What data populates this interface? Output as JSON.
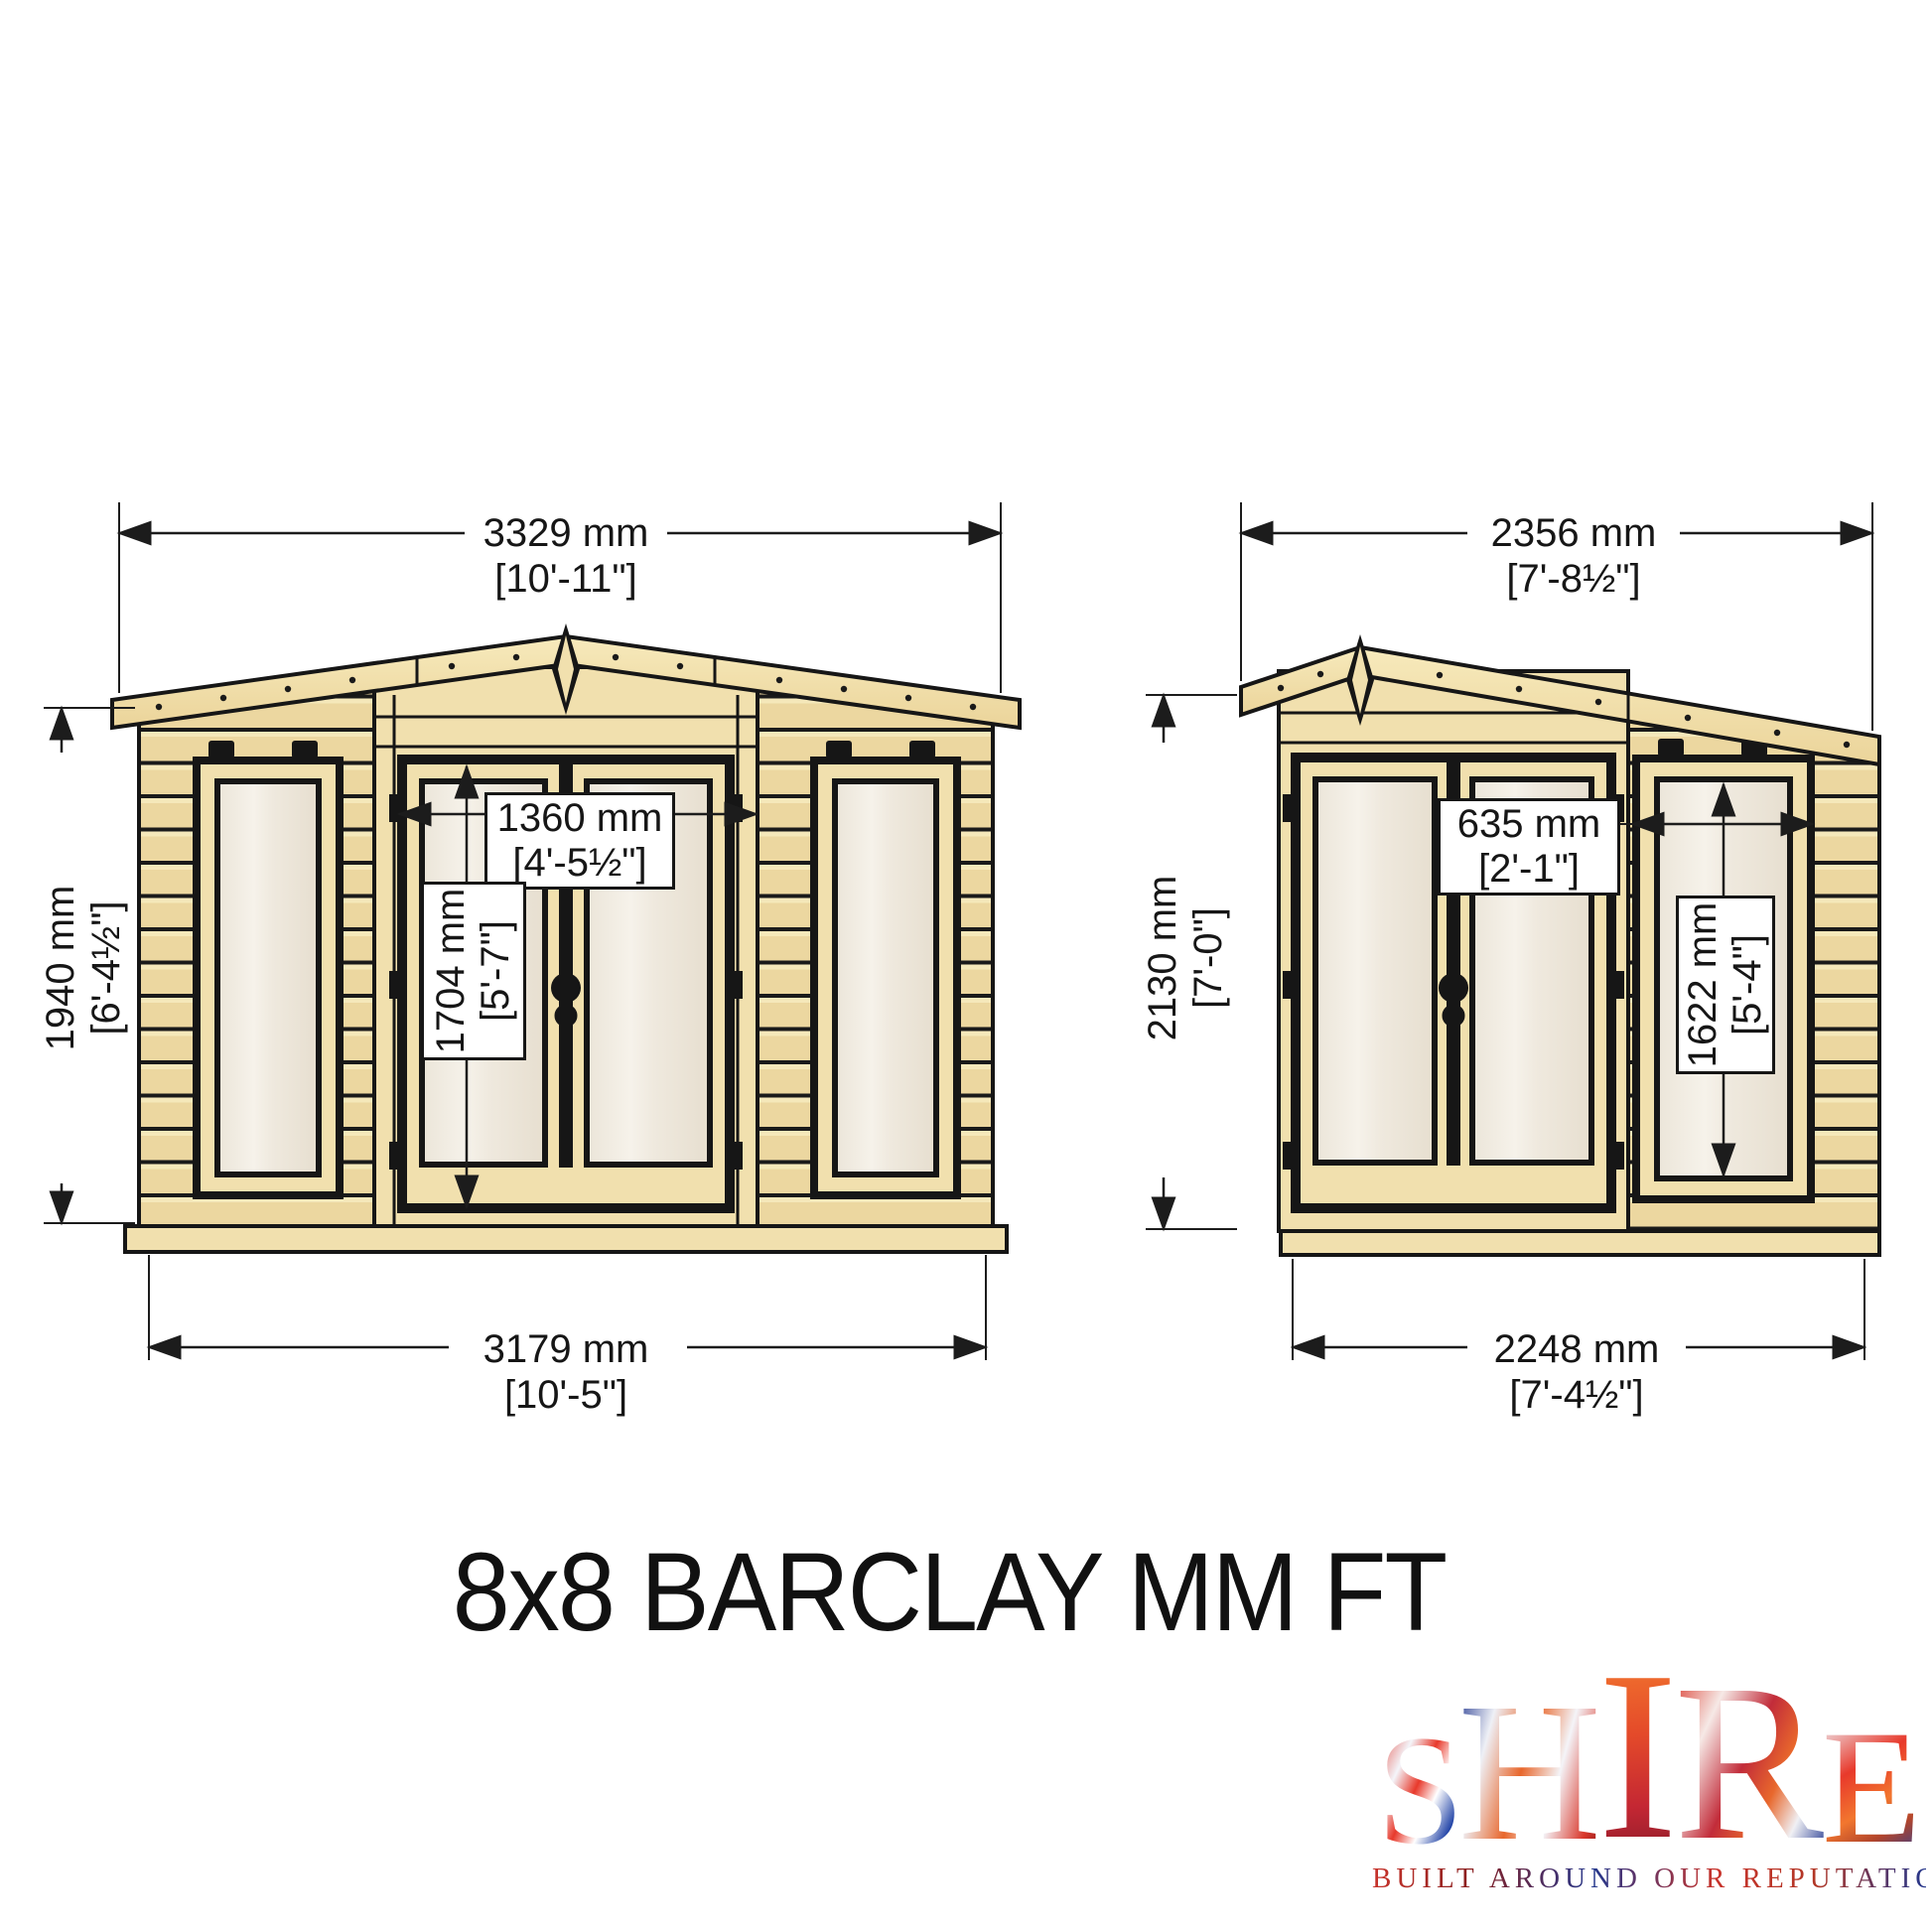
{
  "title": "8x8 BARCLAY MM FT",
  "brand": {
    "name": "SHIRE",
    "letters": [
      "S",
      "H",
      "I",
      "R",
      "E"
    ],
    "tagline": "BUILT AROUND OUR REPUTATION",
    "colors": {
      "red": "#d9372a",
      "blue": "#2b3f94",
      "white": "#f4f5fa"
    }
  },
  "front_view": {
    "label": "front-elevation",
    "overall_width_mm": "3329 mm",
    "overall_width_ft": "[10'-11\"]",
    "wall_height_mm": "1940 mm",
    "wall_height_ft": "[6'-4½\"]",
    "door_width_mm": "1360 mm",
    "door_width_ft": "[4'-5½\"]",
    "door_height_mm": "1704 mm",
    "door_height_ft": "[5'-7\"]",
    "base_width_mm": "3179 mm",
    "base_width_ft": "[10'-5\"]"
  },
  "side_view": {
    "label": "side-elevation",
    "overall_width_mm": "2356 mm",
    "overall_width_ft": "[7'-8½\"]",
    "overall_height_mm": "2130 mm",
    "overall_height_ft": "[7'-0\"]",
    "panel_width_mm": "635 mm",
    "panel_width_ft": "[2'-1\"]",
    "window_height_mm": "1622 mm",
    "window_height_ft": "[5'-4\"]",
    "base_width_mm": "2248 mm",
    "base_width_ft": "[7'-4½\"]"
  },
  "drawing_colors": {
    "wood_trim": "#f1e0ae",
    "wood_cladding": "#ecd7a0",
    "glass": "#f1ece2",
    "outline": "#161616"
  }
}
